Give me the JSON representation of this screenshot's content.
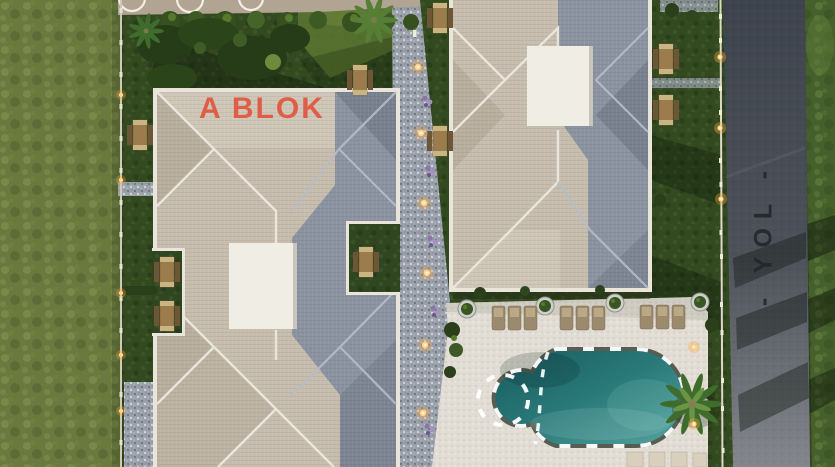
{
  "scene": {
    "labels": {
      "block_a": "A BLOK",
      "road": "- YOL -"
    },
    "colors": {
      "label_a": "#e1563f",
      "label_road": "#23262c",
      "roof_lit": "#c6bdae",
      "roof_shadow": "#8b93a1",
      "ridge_line": "#ece8de",
      "terrace_white": "#f0ede5",
      "wild_grass": "#6a7a3e",
      "lawn": "#33491f",
      "gravel_path": "#9aa1ab",
      "pool_deck": "#e1ddd4",
      "road_asphalt": "#474d55",
      "pool_deep": "#1b6165",
      "pool_light": "#5aa9a2",
      "lounger_tan": "#9b8a6d",
      "picnic_table_wood": "#9c7c4c",
      "path_light": "#ffd391",
      "fence_white": "#ded8c9",
      "flowers_purple": "#9b7fb5",
      "palm_green": "#4e7a33"
    }
  }
}
